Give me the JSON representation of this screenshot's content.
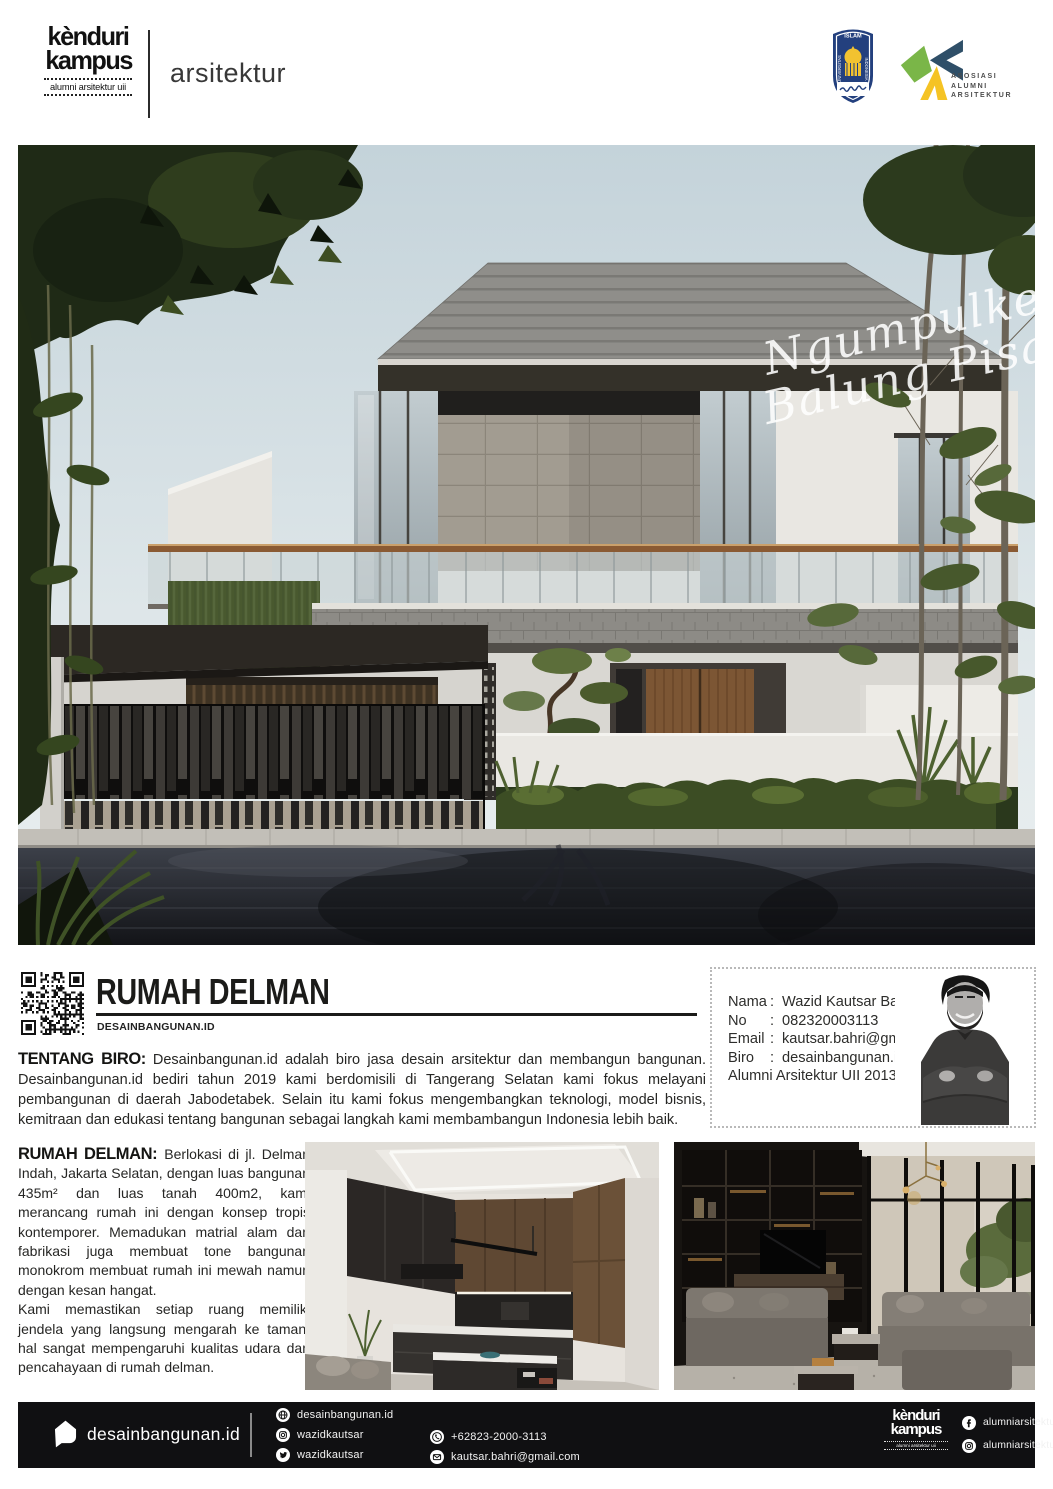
{
  "header": {
    "brand_line1": "kènduri",
    "brand_line2": "kampus",
    "brand_tagline": "alumni arsitektur uii",
    "division": "arsitektur",
    "uii_logo": {
      "top": "ISLAM",
      "left": "UNIVERSITAS",
      "right": "INDONESIA"
    },
    "aaa_logo": {
      "line1": "ASOSIASI",
      "line2": "ALUMNI",
      "line3": "ARSITEKTUR"
    }
  },
  "hero": {
    "script_line1": "Ngumpulke",
    "script_line2": "Balung Pisah"
  },
  "project": {
    "title": "RUMAH DELMAN",
    "subtitle": "DESAINBANGUNAN.ID"
  },
  "contact": {
    "rows": [
      {
        "label": "Nama",
        "value": "Wazid Kautsar Bahri"
      },
      {
        "label": "No",
        "value": "082320003113"
      },
      {
        "label": "Email",
        "value": "kautsar.bahri@gmail.com"
      },
      {
        "label": "Biro",
        "value": "desainbangunan.id"
      }
    ],
    "footnote": "Alumni Arsitektur UII 2013"
  },
  "about": {
    "label": "TENTANG BIRO:",
    "text": "Desainbangunan.id adalah biro jasa desain arsitektur dan membangun bangunan. Desainbangunan.id bediri tahun 2019 kami berdomisili di Tangerang Selatan kami fokus melayani pembangunan di daerah Jabodetabek. Selain itu kami fokus mengembangkan teknologi, model bisnis, kemitraan dan edukasi tentang bangunan sebagai langkah kami membambangun Indonesia lebih baik."
  },
  "description": {
    "label": "RUMAH DELMAN:",
    "para1": "Berlokasi di jl. Delman Indah, Jakarta Selatan, dengan luas bangunan 435m² dan luas tanah 400m2, kami merancang rumah ini dengan konsep tropis kontemporer. Memadukan matrial alam dan fabrikasi juga membuat tone bangunan monokrom membuat rumah ini mewah namun dengan kesan hangat.",
    "para2": "Kami memastikan setiap ruang memiliki jendela yang langsung mengarah ke taman, hal sangat mempengaruhi kualitas udara dan pencahayaan di rumah delman."
  },
  "footer": {
    "brand": "desainbangunan.id",
    "links": [
      {
        "icon": "website-icon",
        "text": "desainbangunan.id"
      },
      {
        "icon": "instagram-icon",
        "text": "wazidkautsar"
      },
      {
        "icon": "twitter-icon",
        "text": "wazidkautsar"
      }
    ],
    "contacts": [
      {
        "icon": "whatsapp-icon",
        "text": "+62823-2000-3113"
      },
      {
        "icon": "email-icon",
        "text": "kautsar.bahri@gmail.com"
      }
    ],
    "kenduri": {
      "line1": "kènduri",
      "line2": "kampus",
      "tagline": "alumni arsitektur uii"
    },
    "alumni_links": [
      {
        "icon": "facebook-icon",
        "text": "alumniarsitekturuii"
      },
      {
        "icon": "instagram-icon",
        "text": "alumniarsitekturuii"
      }
    ]
  },
  "colors": {
    "uii_blue": "#23407e",
    "aaa_green": "#7ab648",
    "aaa_blue": "#2f4f68",
    "aaa_yellow": "#f5c324",
    "footer_bg": "#101012"
  }
}
